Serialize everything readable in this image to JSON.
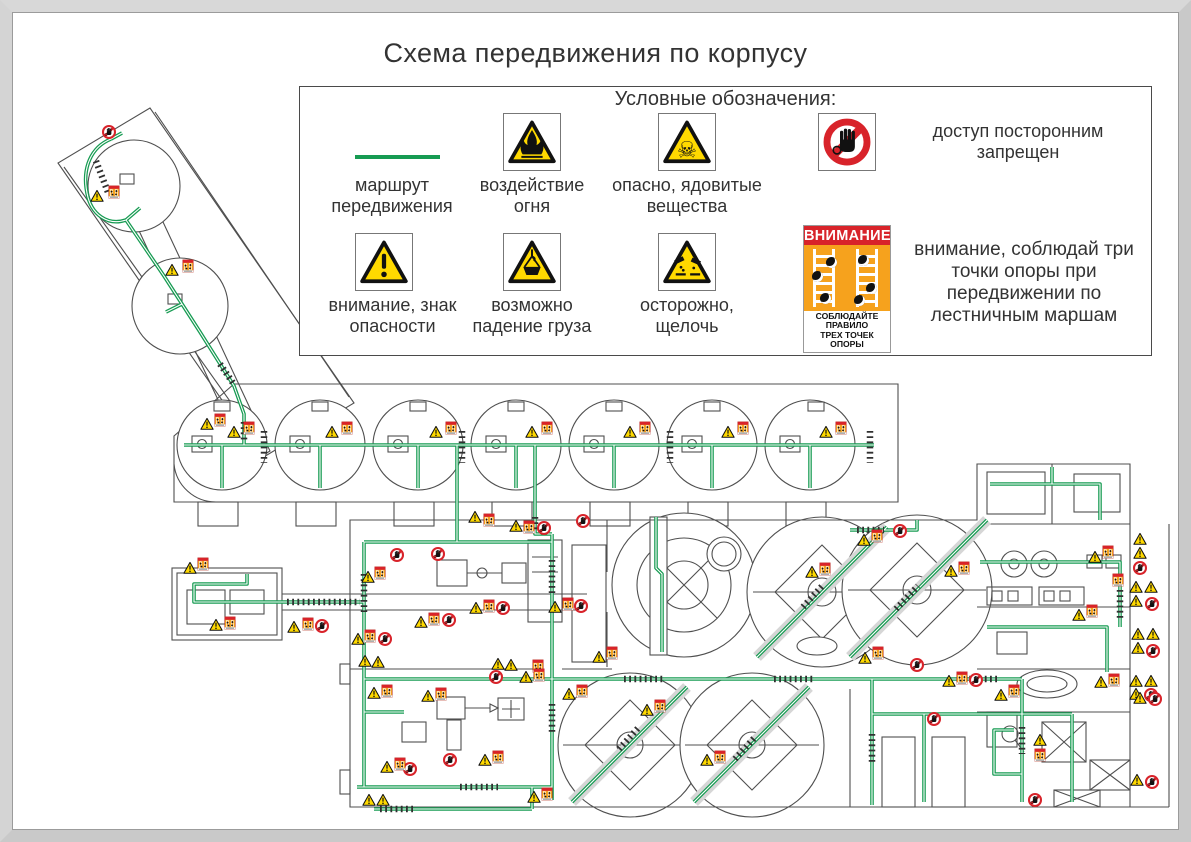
{
  "title": "Схема передвижения по корпусу",
  "legend": {
    "title": "Условные обозначения:",
    "items": [
      {
        "id": "route",
        "label": "маршрут передвижения"
      },
      {
        "id": "fire",
        "label": "воздействие огня"
      },
      {
        "id": "toxic",
        "label": "опасно, ядовитые вещества"
      },
      {
        "id": "no-access",
        "label": "доступ посторонним запрещен"
      },
      {
        "id": "danger",
        "label": "внимание, знак опасности"
      },
      {
        "id": "load",
        "label": "возможно падение груза"
      },
      {
        "id": "alkali",
        "label": "осторожно, щелочь"
      },
      {
        "id": "three-points",
        "label": "внимание, соблюдай три точки опоры при передвижении по лестничным маршам"
      }
    ],
    "poster": {
      "header": "ВНИМАНИЕ",
      "footer_line1": "СОБЛЮДАЙТЕ ПРАВИЛО",
      "footer_line2": "ТРЕХ ТОЧЕК ОПОРЫ"
    }
  },
  "colors": {
    "route_green": "#169b52",
    "warn_yellow": "#ffd900",
    "poster_orange": "#f6a21d",
    "alert_red": "#d8232a",
    "line_gray": "#4f4f4f"
  },
  "plan": {
    "icons": [
      {
        "t": "n",
        "x": 97,
        "y": 120
      },
      {
        "t": "tri",
        "x": 85,
        "y": 184
      },
      {
        "t": "sq",
        "x": 102,
        "y": 180
      },
      {
        "t": "tri",
        "x": 160,
        "y": 258
      },
      {
        "t": "sq",
        "x": 176,
        "y": 254
      },
      {
        "t": "tri",
        "x": 195,
        "y": 412
      },
      {
        "t": "sq",
        "x": 208,
        "y": 408
      },
      {
        "t": "tri",
        "x": 222,
        "y": 420
      },
      {
        "t": "sq",
        "x": 237,
        "y": 416
      },
      {
        "t": "tri",
        "x": 320,
        "y": 420
      },
      {
        "t": "sq",
        "x": 335,
        "y": 416
      },
      {
        "t": "tri",
        "x": 424,
        "y": 420
      },
      {
        "t": "sq",
        "x": 439,
        "y": 416
      },
      {
        "t": "tri",
        "x": 520,
        "y": 420
      },
      {
        "t": "sq",
        "x": 535,
        "y": 416
      },
      {
        "t": "tri",
        "x": 618,
        "y": 420
      },
      {
        "t": "sq",
        "x": 633,
        "y": 416
      },
      {
        "t": "tri",
        "x": 716,
        "y": 420
      },
      {
        "t": "sq",
        "x": 731,
        "y": 416
      },
      {
        "t": "tri",
        "x": 814,
        "y": 420
      },
      {
        "t": "sq",
        "x": 829,
        "y": 416
      },
      {
        "t": "tri",
        "x": 463,
        "y": 505
      },
      {
        "t": "sq",
        "x": 477,
        "y": 508
      },
      {
        "t": "tri",
        "x": 504,
        "y": 514
      },
      {
        "t": "sq",
        "x": 517,
        "y": 515
      },
      {
        "t": "n",
        "x": 532,
        "y": 516
      },
      {
        "t": "n",
        "x": 571,
        "y": 509
      },
      {
        "t": "tri",
        "x": 852,
        "y": 528
      },
      {
        "t": "sq",
        "x": 865,
        "y": 524
      },
      {
        "t": "n",
        "x": 888,
        "y": 519
      },
      {
        "t": "tri",
        "x": 178,
        "y": 556
      },
      {
        "t": "sq",
        "x": 191,
        "y": 552
      },
      {
        "t": "tri",
        "x": 204,
        "y": 613
      },
      {
        "t": "sq",
        "x": 218,
        "y": 611
      },
      {
        "t": "tri",
        "x": 282,
        "y": 615
      },
      {
        "t": "sq",
        "x": 296,
        "y": 612
      },
      {
        "t": "n",
        "x": 310,
        "y": 614
      },
      {
        "t": "n",
        "x": 385,
        "y": 543
      },
      {
        "t": "n",
        "x": 426,
        "y": 542
      },
      {
        "t": "tri",
        "x": 356,
        "y": 565
      },
      {
        "t": "sq",
        "x": 368,
        "y": 561
      },
      {
        "t": "tri",
        "x": 464,
        "y": 596
      },
      {
        "t": "sq",
        "x": 477,
        "y": 594
      },
      {
        "t": "n",
        "x": 491,
        "y": 596
      },
      {
        "t": "tri",
        "x": 543,
        "y": 595
      },
      {
        "t": "sq",
        "x": 556,
        "y": 592
      },
      {
        "t": "n",
        "x": 569,
        "y": 594
      },
      {
        "t": "tri",
        "x": 409,
        "y": 610
      },
      {
        "t": "sq",
        "x": 422,
        "y": 607
      },
      {
        "t": "n",
        "x": 437,
        "y": 608
      },
      {
        "t": "tri",
        "x": 346,
        "y": 627
      },
      {
        "t": "sq",
        "x": 358,
        "y": 624
      },
      {
        "t": "n",
        "x": 373,
        "y": 627
      },
      {
        "t": "tri",
        "x": 353,
        "y": 649
      },
      {
        "t": "tri",
        "x": 366,
        "y": 650
      },
      {
        "t": "tri",
        "x": 486,
        "y": 652
      },
      {
        "t": "tri",
        "x": 499,
        "y": 653
      },
      {
        "t": "sq",
        "x": 526,
        "y": 654
      },
      {
        "t": "tri",
        "x": 587,
        "y": 645
      },
      {
        "t": "sq",
        "x": 600,
        "y": 641
      },
      {
        "t": "tri",
        "x": 853,
        "y": 646
      },
      {
        "t": "sq",
        "x": 866,
        "y": 641
      },
      {
        "t": "n",
        "x": 905,
        "y": 653
      },
      {
        "t": "tri",
        "x": 362,
        "y": 681
      },
      {
        "t": "sq",
        "x": 375,
        "y": 679
      },
      {
        "t": "tri",
        "x": 416,
        "y": 684
      },
      {
        "t": "sq",
        "x": 429,
        "y": 682
      },
      {
        "t": "n",
        "x": 484,
        "y": 665
      },
      {
        "t": "tri",
        "x": 514,
        "y": 665
      },
      {
        "t": "sq",
        "x": 527,
        "y": 663
      },
      {
        "t": "tri",
        "x": 557,
        "y": 682
      },
      {
        "t": "sq",
        "x": 570,
        "y": 679
      },
      {
        "t": "n",
        "x": 398,
        "y": 757
      },
      {
        "t": "n",
        "x": 438,
        "y": 748
      },
      {
        "t": "tri",
        "x": 375,
        "y": 755
      },
      {
        "t": "sq",
        "x": 388,
        "y": 752
      },
      {
        "t": "tri",
        "x": 473,
        "y": 748
      },
      {
        "t": "sq",
        "x": 486,
        "y": 745
      },
      {
        "t": "tri",
        "x": 357,
        "y": 788
      },
      {
        "t": "tri",
        "x": 371,
        "y": 788
      },
      {
        "t": "tri",
        "x": 522,
        "y": 785
      },
      {
        "t": "sq",
        "x": 535,
        "y": 782
      },
      {
        "t": "tri",
        "x": 800,
        "y": 560
      },
      {
        "t": "sq",
        "x": 813,
        "y": 557
      },
      {
        "t": "tri",
        "x": 939,
        "y": 559
      },
      {
        "t": "sq",
        "x": 952,
        "y": 556
      },
      {
        "t": "tri",
        "x": 635,
        "y": 698
      },
      {
        "t": "sq",
        "x": 648,
        "y": 694
      },
      {
        "t": "tri",
        "x": 695,
        "y": 748
      },
      {
        "t": "sq",
        "x": 708,
        "y": 745
      },
      {
        "t": "tri",
        "x": 937,
        "y": 669
      },
      {
        "t": "sq",
        "x": 950,
        "y": 666
      },
      {
        "t": "n",
        "x": 964,
        "y": 668
      },
      {
        "t": "n",
        "x": 922,
        "y": 707
      },
      {
        "t": "tri",
        "x": 1083,
        "y": 545
      },
      {
        "t": "sq",
        "x": 1096,
        "y": 540
      },
      {
        "t": "sq",
        "x": 1106,
        "y": 568
      },
      {
        "t": "tri",
        "x": 1067,
        "y": 603
      },
      {
        "t": "sq",
        "x": 1080,
        "y": 599
      },
      {
        "t": "tri",
        "x": 1089,
        "y": 670
      },
      {
        "t": "sq",
        "x": 1102,
        "y": 668
      },
      {
        "t": "tri",
        "x": 989,
        "y": 683
      },
      {
        "t": "sq",
        "x": 1002,
        "y": 679
      },
      {
        "t": "tri",
        "x": 1028,
        "y": 728
      },
      {
        "t": "sq",
        "x": 1028,
        "y": 743
      },
      {
        "t": "n",
        "x": 1023,
        "y": 788
      },
      {
        "t": "tri",
        "x": 1128,
        "y": 527
      },
      {
        "t": "tri",
        "x": 1128,
        "y": 541
      },
      {
        "t": "n",
        "x": 1128,
        "y": 556
      },
      {
        "t": "tri",
        "x": 1124,
        "y": 575
      },
      {
        "t": "tri",
        "x": 1139,
        "y": 575
      },
      {
        "t": "tri",
        "x": 1124,
        "y": 589
      },
      {
        "t": "n",
        "x": 1140,
        "y": 592
      },
      {
        "t": "tri",
        "x": 1126,
        "y": 622
      },
      {
        "t": "tri",
        "x": 1141,
        "y": 622
      },
      {
        "t": "tri",
        "x": 1126,
        "y": 636
      },
      {
        "t": "n",
        "x": 1141,
        "y": 639
      },
      {
        "t": "tri",
        "x": 1124,
        "y": 669
      },
      {
        "t": "tri",
        "x": 1139,
        "y": 669
      },
      {
        "t": "tri",
        "x": 1124,
        "y": 682
      },
      {
        "t": "n",
        "x": 1139,
        "y": 683
      },
      {
        "t": "tri",
        "x": 1128,
        "y": 686
      },
      {
        "t": "n",
        "x": 1143,
        "y": 687
      },
      {
        "t": "tri",
        "x": 1125,
        "y": 768
      },
      {
        "t": "n",
        "x": 1140,
        "y": 770
      }
    ]
  }
}
